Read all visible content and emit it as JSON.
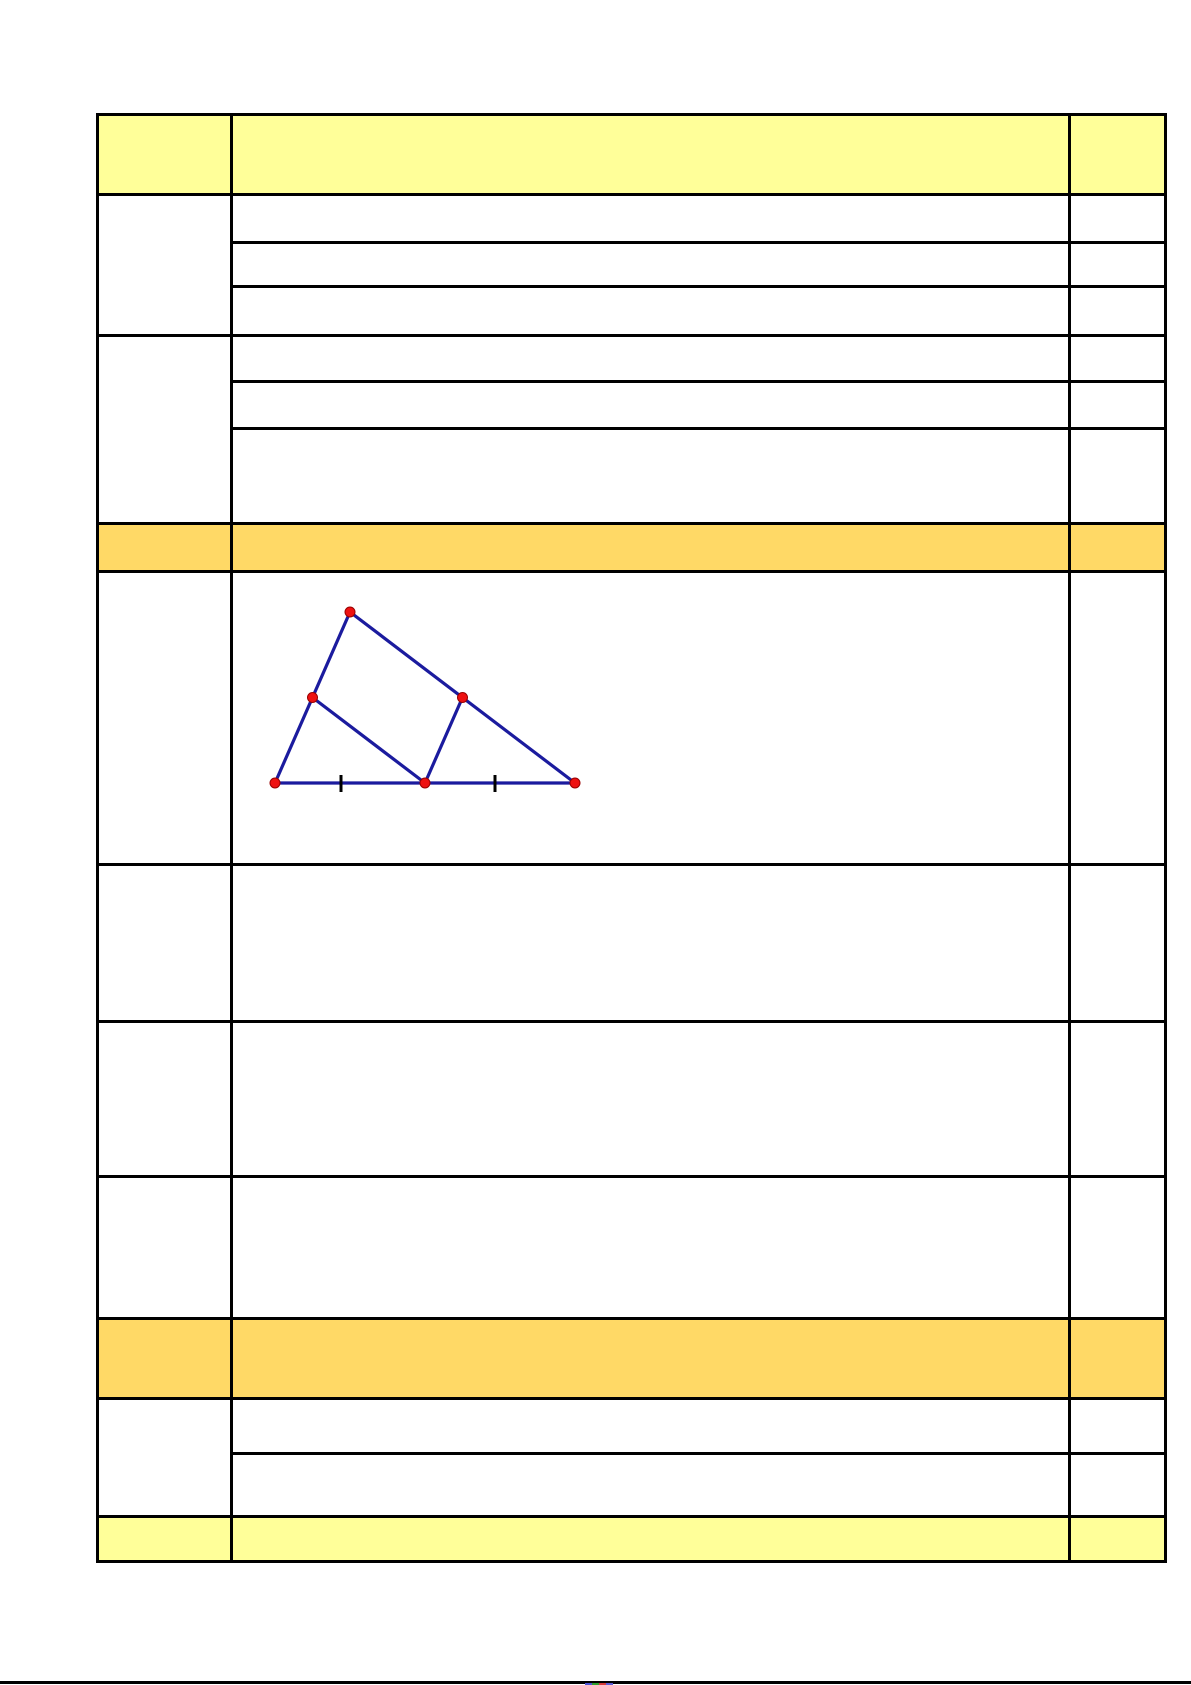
{
  "page": {
    "background": "#ffffff",
    "description": "Blank worksheet answer grid with one geometric figure (triangle with midsegments); all text cells are empty."
  },
  "table": {
    "grid_color": "#000000",
    "header_fill": "#FFFF99",
    "section_fill": "#FFD966",
    "footer_fill": "#FFFF99",
    "body_fill": "#ffffff",
    "columns": [
      {
        "name": "label-column"
      },
      {
        "name": "content-column"
      },
      {
        "name": "points-column"
      }
    ]
  },
  "diagram": {
    "type": "geometry-figure",
    "figure": "triangle with two midsegments forming a parallelogram; base split into two equal parts marked with ticks",
    "stroke_color": "#1b1b9e",
    "point_fill": "#ee1111",
    "point_stroke": "#990000",
    "tick_color": "#000000",
    "line_width": 3.2,
    "tick_width": 3,
    "point_radius": 5,
    "canvas": {
      "width": 835,
      "height": 285
    },
    "points": [
      {
        "name": "bottom-left-vertex",
        "x": 42,
        "y": 210
      },
      {
        "name": "apex-vertex",
        "x": 117,
        "y": 39
      },
      {
        "name": "bottom-right-vertex",
        "x": 342,
        "y": 210
      },
      {
        "name": "left-midpoint",
        "x": 79.5,
        "y": 124.5
      },
      {
        "name": "right-midpoint",
        "x": 229.5,
        "y": 124.5
      },
      {
        "name": "base-midpoint",
        "x": 192,
        "y": 210
      }
    ],
    "segments": [
      {
        "from": 0,
        "to": 1
      },
      {
        "from": 1,
        "to": 2
      },
      {
        "from": 0,
        "to": 2
      },
      {
        "from": 3,
        "to": 5
      },
      {
        "from": 4,
        "to": 5
      }
    ],
    "ticks": [
      {
        "x": 108,
        "y1": 202,
        "y2": 219
      },
      {
        "x": 262,
        "y1": 202,
        "y2": 219
      }
    ]
  },
  "footer": {
    "rule_color": "#000000",
    "sliver_colors": [
      "#4a52d4",
      "#2e9e2e",
      "#d43a3a",
      "#5a5ad4"
    ]
  }
}
